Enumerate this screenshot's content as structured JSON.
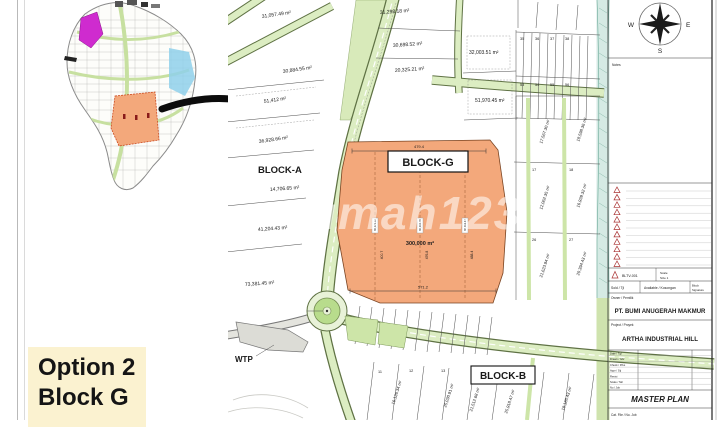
{
  "option_box": {
    "line1": "Option 2",
    "line2": "Block G"
  },
  "watermark": "rumah123",
  "compass": {
    "n": "N",
    "e": "E",
    "s": "S",
    "w": "W"
  },
  "map": {
    "blocks": {
      "a": "BLOCK-A",
      "g": "BLOCK-G",
      "b": "BLOCK-B"
    },
    "block_g": {
      "area": "300,000 m²",
      "dim_top": "479.4",
      "dim_bottom": "571.2",
      "dim_v1": "400.7",
      "dim_v2": "476.8",
      "dim_v3": "488.4",
      "stamp1": "60,376.02",
      "stamp2": "60,310.76",
      "stamp3": "60,312.47"
    },
    "wtp": "WTP",
    "parcels": [
      "31,057.49 m²",
      "31,298.18 m²",
      "30,884.55 m²",
      "51,412 m²",
      "30,698.52 m²",
      "20,325.21 m²",
      "32,003.51 m²",
      "51,970.45 m²",
      "36,928.66 m²",
      "14,706.65 m²",
      "41,204.43 m²",
      "73,381.45 m²",
      "10,791.08 m²"
    ],
    "parcels_east": [
      "17,567.30 m²",
      "18,598.36 m²",
      "12,062.35 m²",
      "16,939.32 m²",
      "21,623.94 m²",
      "20,394.43 m²"
    ],
    "parcels_south": [
      "16,126.34 m²",
      "25,030.91 m²",
      "21,512.68 m²",
      "25,918.47 m²",
      "18,185.43 m²"
    ],
    "lots": [
      "35",
      "36",
      "37",
      "38",
      "53",
      "54",
      "55",
      "56",
      "17",
      "18",
      "26",
      "27",
      "11",
      "12",
      "13"
    ]
  },
  "title_block": {
    "notes": "Notes",
    "ref": "BLTV-001",
    "scale1": "Scale",
    "scale2": "Size 1",
    "sold": "Sold / Tjl",
    "available": "Available / Kosongan",
    "sign1": "Block",
    "sign2": "Signature",
    "owner_label": "Owner / Pemilik",
    "owner": "PT. BUMI ANUGERAH MAKMUR",
    "project_label": "Project / Proyek",
    "project": "ARTHA INDUSTRIAL HILL",
    "rows": [
      "Date / Tgl",
      "Drawn / Gbr",
      "Check / Prks",
      "Appr / Stj",
      "Revisi",
      "Scale / Skl",
      "No / Job"
    ],
    "doc_title": "MASTER PLAN",
    "footer": "Cat. File / No. Job"
  }
}
